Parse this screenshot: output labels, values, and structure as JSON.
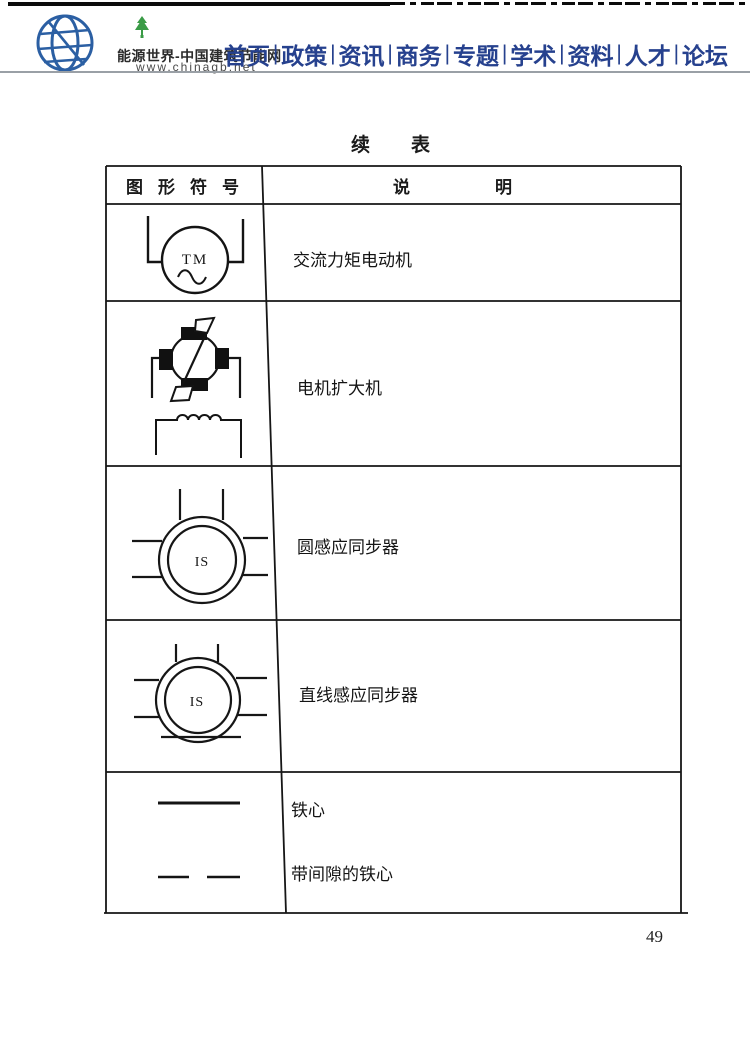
{
  "header": {
    "logo": {
      "site_name": "能源世界-中国建筑节能网",
      "site_url": "www.chinagb.net",
      "globe_icon": "globe-icon",
      "tree_icon": "tree-icon",
      "globe_color": "#2b5fa3",
      "tree_color": "#3a9b46"
    },
    "nav": {
      "separator": "|",
      "color": "#26418e",
      "items": [
        "首页",
        "政策",
        "资讯",
        "商务",
        "专题",
        "学术",
        "资料",
        "人才",
        "论坛"
      ]
    }
  },
  "document": {
    "continued_table_label": "续表",
    "table": {
      "col1_header": "图形符号",
      "col2_header": "说明",
      "line_color": "#161616",
      "rows": [
        {
          "symbol_name": "ac-torque-motor-symbol",
          "symbol_label": "TM",
          "description": "交流力矩电动机"
        },
        {
          "symbol_name": "rotating-machine-amplifier-symbol",
          "symbol_label": "",
          "description": "电机扩大机"
        },
        {
          "symbol_name": "circular-induction-synchronizer-symbol",
          "symbol_label": "IS",
          "description": "圆感应同步器"
        },
        {
          "symbol_name": "linear-induction-synchronizer-symbol",
          "symbol_label": "IS",
          "description": "直线感应同步器"
        },
        {
          "symbol_name": "iron-core-symbol",
          "symbol_label": "",
          "description": "铁心"
        },
        {
          "symbol_name": "iron-core-with-gap-symbol",
          "symbol_label": "",
          "description": "带间隙的铁心"
        }
      ]
    },
    "page_number": "49"
  }
}
